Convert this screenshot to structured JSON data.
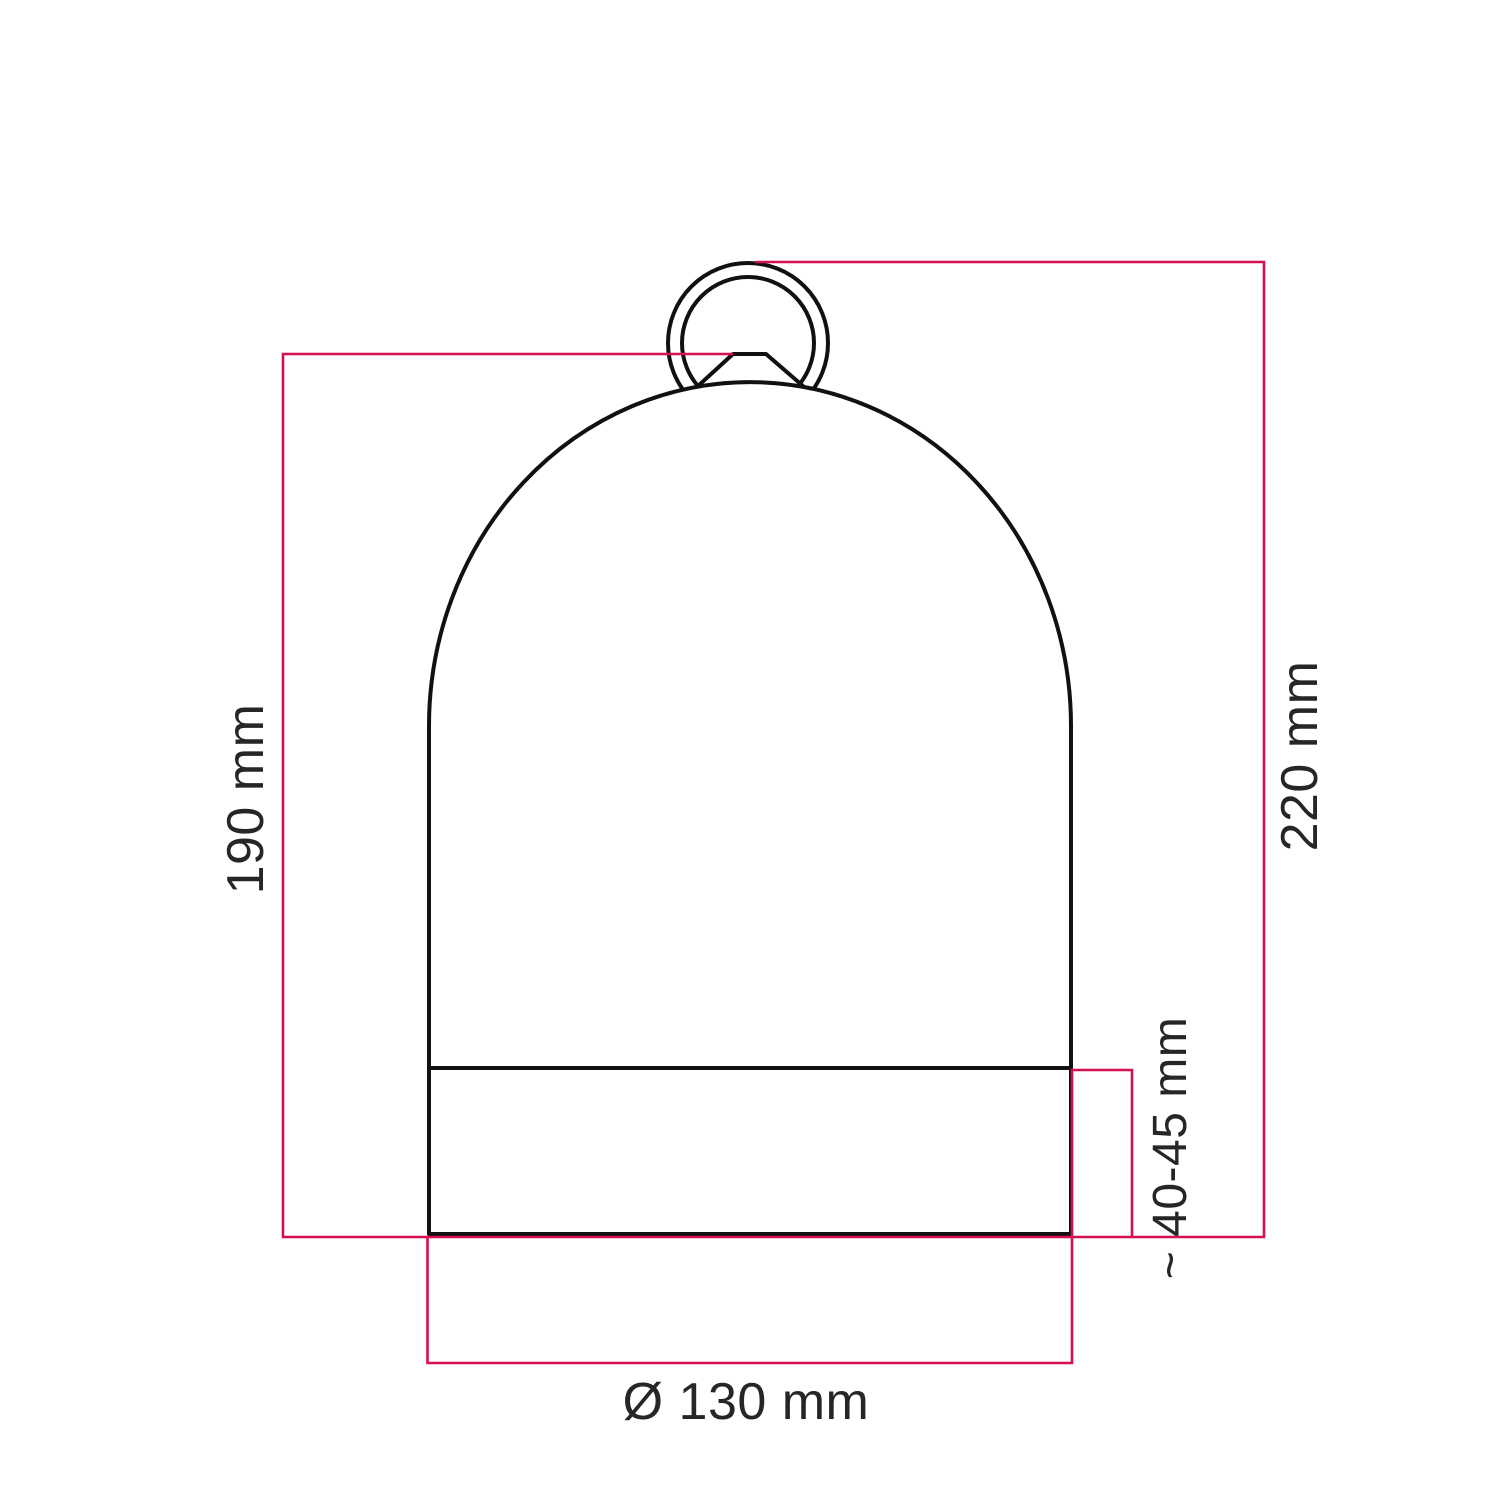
{
  "figure": {
    "colors": {
      "outline": "#111111",
      "dimension_line": "#d30f56",
      "text": "#262624",
      "background": "#ffffff"
    },
    "dimensions": {
      "left_height": {
        "label": "190 mm"
      },
      "right_height": {
        "label": "220 mm"
      },
      "band_height": {
        "label": "~ 40-45 mm"
      },
      "base_diameter": {
        "label": "Ø 130 mm"
      }
    }
  }
}
